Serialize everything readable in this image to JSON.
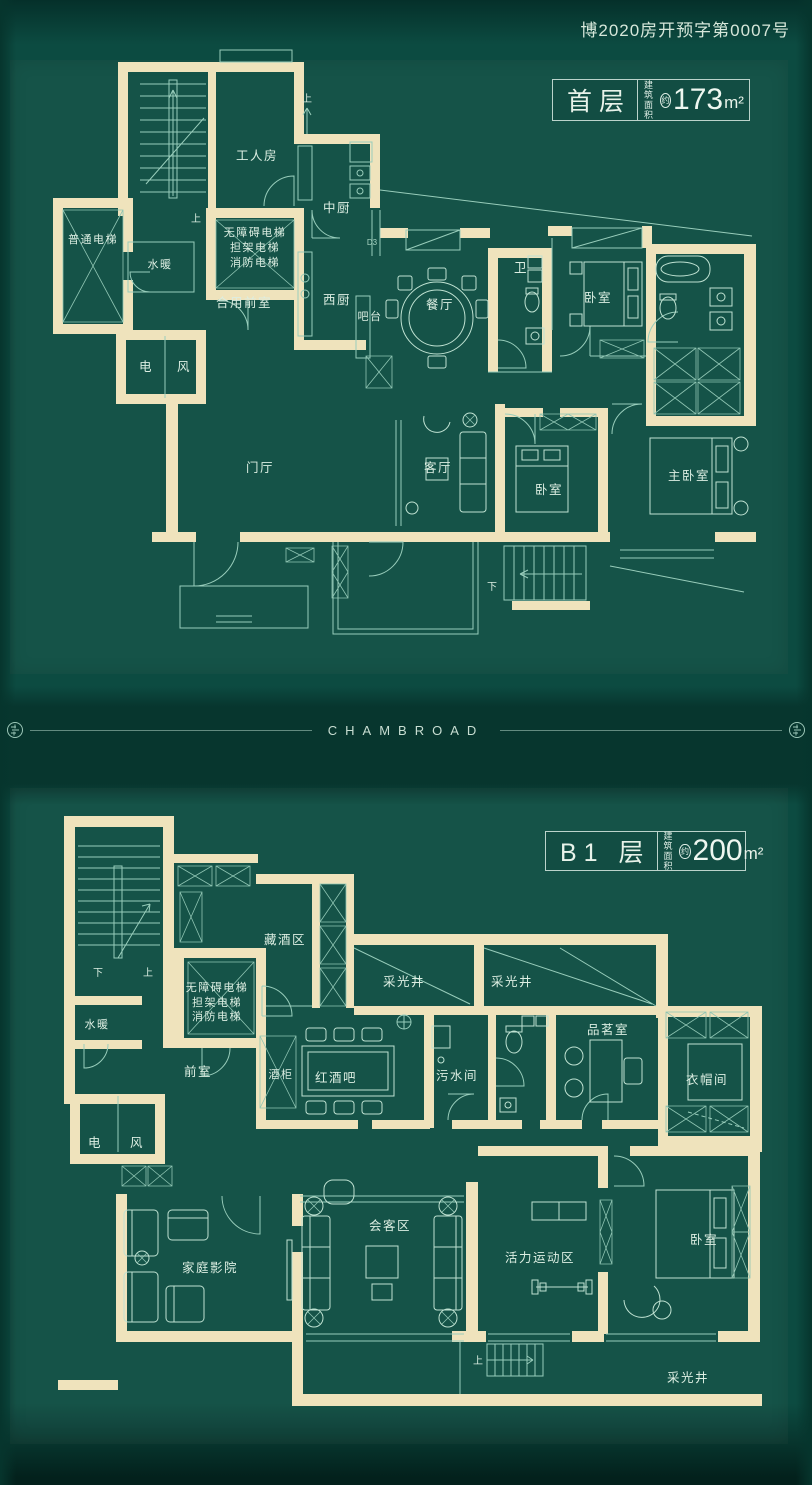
{
  "page": {
    "permit": "博2020房开预字第0007号"
  },
  "divider": {
    "brand": "CHAMBROAD"
  },
  "colors": {
    "background": "#0c4b41",
    "wall": "#efe3bc",
    "line": "#98cdbb",
    "text": "#dceee2"
  },
  "floor1": {
    "name": "首层",
    "area": {
      "label_top": "建筑",
      "label_bottom": "面积",
      "approx": "约",
      "value": "173",
      "unit": "m²"
    },
    "rooms": {
      "worker_room": "工人房",
      "up_top": "上",
      "stair_up": "上",
      "mid_kitchen": "中厨",
      "normal_elevator": "普通电梯",
      "water_heating": "水暖",
      "elevator_1": "无障碍电梯",
      "elevator_2": "担架电梯",
      "elevator_3": "消防电梯",
      "shared_front_room": "合用前室",
      "west_kitchen": "西厨",
      "bar_counter": "吧台",
      "dining_room": "餐厅",
      "bathroom": "卫",
      "bedroom_top": "卧室",
      "electric": "电",
      "vent": "风",
      "door_code": "D3",
      "entry_hall": "门厅",
      "living_room": "客厅",
      "bedroom_mid": "卧室",
      "master_bedroom": "主卧室",
      "stair_down": "下"
    }
  },
  "floorB1": {
    "name": "B1 层",
    "area": {
      "label_top": "建筑",
      "label_bottom": "面积",
      "approx": "约",
      "value": "200",
      "unit": "m²"
    },
    "rooms": {
      "stair_down": "下",
      "stair_up": "上",
      "wine_storage": "藏酒区",
      "light_well_1": "采光井",
      "light_well_2": "采光井",
      "light_well_3": "采光井",
      "elevator_1": "无障碍电梯",
      "elevator_2": "担架电梯",
      "elevator_3": "消防电梯",
      "water_heating": "水暖",
      "front_room": "前室",
      "wine_cabinet": "酒柜",
      "wine_bar": "红酒吧",
      "sewage_room": "污水间",
      "tea_room": "品茗室",
      "cloakroom": "衣帽间",
      "electric": "电",
      "vent": "风",
      "home_theater": "家庭影院",
      "meeting_area": "会客区",
      "sports_area": "活力运动区",
      "bedroom": "卧室",
      "stair_up_2": "上"
    }
  }
}
